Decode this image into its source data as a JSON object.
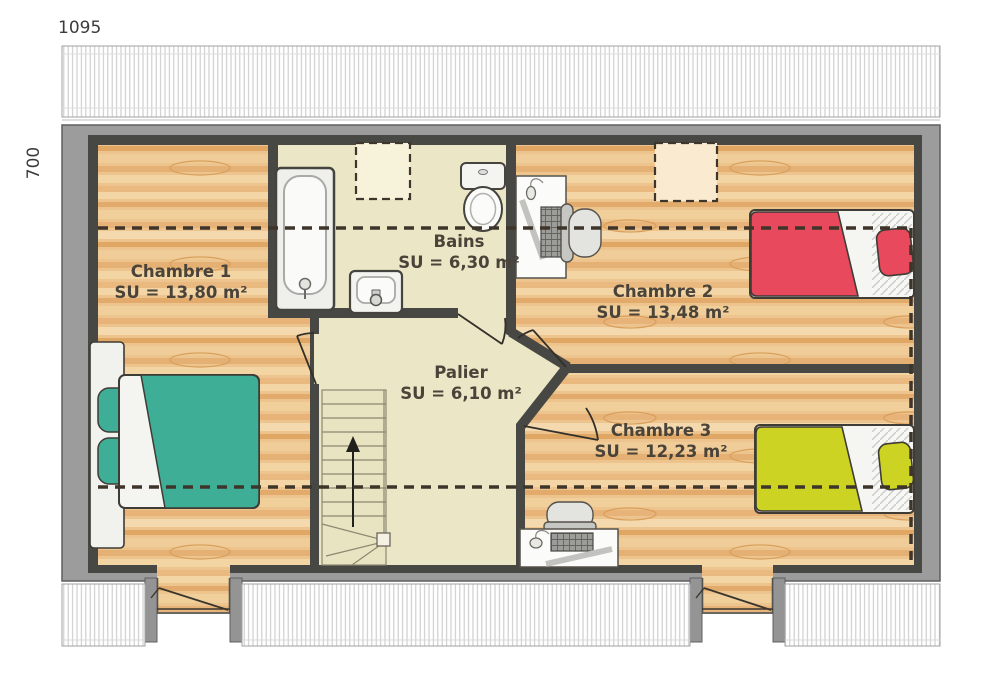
{
  "plan": {
    "dimension_width": "1095",
    "dimension_height": "700",
    "rooms": [
      {
        "label": "Chambre 1",
        "area": "SU = 13,80 m²"
      },
      {
        "label": "Bains",
        "area": "SU = 6,30 m²"
      },
      {
        "label": "Chambre 2",
        "area": "SU = 13,48 m²"
      },
      {
        "label": "Palier",
        "area": "SU = 6,10 m²"
      },
      {
        "label": "Chambre 3",
        "area": "SU = 12,23 m²"
      }
    ],
    "colors": {
      "wood_floor": "#edc48d",
      "tile_floor": "#ebe6c6",
      "wall_light": "#9c9c9c",
      "wall_dark": "#474743",
      "bed_teal": "#3fae96",
      "bed_red": "#e8495c",
      "bed_yellow": "#cdd322",
      "dash_line": "#3e352a"
    }
  }
}
